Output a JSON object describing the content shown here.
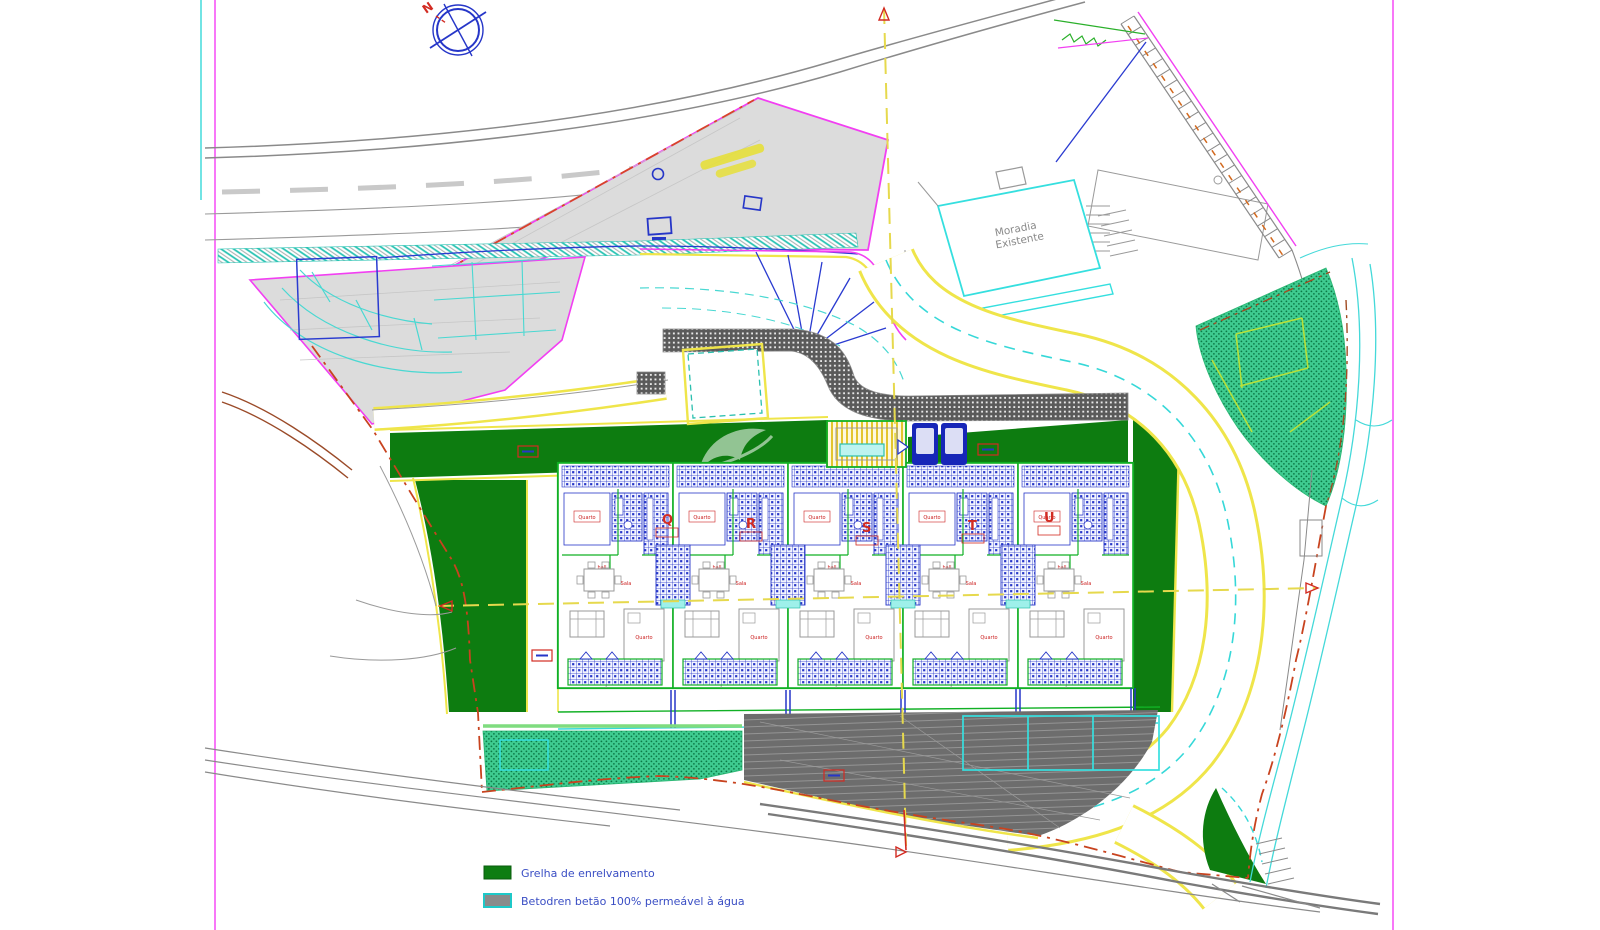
{
  "compass": {
    "north": "N"
  },
  "existing_house": {
    "line1": "Moradia",
    "line2": "Existente"
  },
  "plan": {
    "units": [
      {
        "label": "Q"
      },
      {
        "label": "R"
      },
      {
        "label": "S"
      },
      {
        "label": "T"
      },
      {
        "label": "U"
      }
    ],
    "room_labels": {
      "bedroom": "Quarto",
      "living": "Sala",
      "hall": "hall"
    }
  },
  "legend": {
    "items": [
      {
        "label": "Grelha de enrelvamento",
        "swatch_color": "#0e7d12",
        "swatch_border": "#0a5c0e"
      },
      {
        "label": "Betodren betão 100% permeável à água",
        "swatch_color": "#8a8a8a",
        "swatch_border": "#1ec8c8"
      }
    ]
  },
  "colors": {
    "lawn": "#0d7c10",
    "road_edge_yellow": "#efe54a",
    "boundary_red": "#c8431f",
    "magenta": "#f23ff2",
    "plan_blue": "#2636c8",
    "cyan": "#36d8d8",
    "crosshatch_green": "#3fcb90"
  }
}
